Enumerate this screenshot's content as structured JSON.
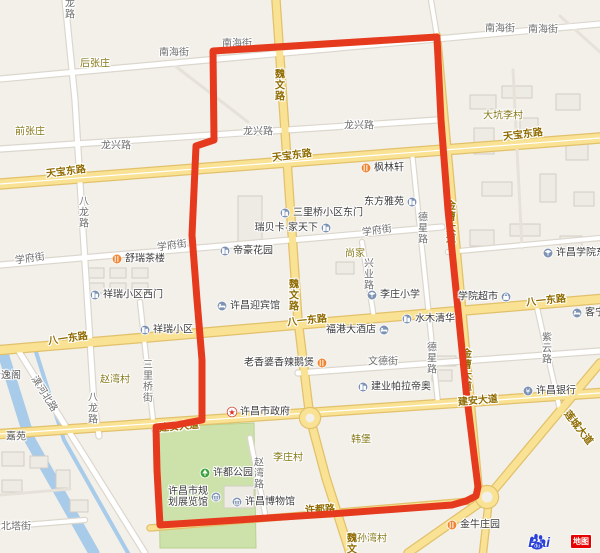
{
  "map": {
    "colors": {
      "background": "#f3f0ea",
      "route": "#e63a1e",
      "major_road": "#f9e293",
      "major_casing": "#e2c16b",
      "minor_road": "#ffffff",
      "minor_casing": "#dcd7cd",
      "faint_road": "#e7e2d9",
      "water": "#a7cbe9",
      "park": "#cde2ab",
      "building_fill": "#eeebe4",
      "building_stroke": "#d2cec5"
    },
    "water": [
      {
        "w": 11,
        "pts": [
          [
            2,
            350
          ],
          [
            30,
            440
          ],
          [
            94,
            553
          ]
        ]
      },
      {
        "w": 4,
        "pts": [
          [
            36,
            352
          ],
          [
            64,
            440
          ],
          [
            128,
            553
          ]
        ]
      }
    ],
    "park": {
      "name": "许都公园绿地",
      "points": [
        [
          158,
          427
        ],
        [
          254,
          423
        ],
        [
          256,
          548
        ],
        [
          160,
          548
        ]
      ]
    },
    "buildings": [
      [
        238,
        196,
        24,
        46
      ],
      [
        470,
        95,
        26,
        14
      ],
      [
        502,
        86,
        30,
        12
      ],
      [
        474,
        128,
        20,
        26
      ],
      [
        520,
        118,
        18,
        30
      ],
      [
        556,
        94,
        24,
        16
      ],
      [
        566,
        138,
        22,
        22
      ],
      [
        482,
        182,
        30,
        14
      ],
      [
        540,
        174,
        16,
        28
      ],
      [
        574,
        192,
        20,
        14
      ],
      [
        470,
        230,
        24,
        16
      ],
      [
        510,
        224,
        30,
        12
      ],
      [
        560,
        236,
        22,
        14
      ],
      [
        88,
        268,
        16,
        10
      ],
      [
        110,
        268,
        16,
        10
      ],
      [
        132,
        268,
        16,
        10
      ],
      [
        88,
        283,
        16,
        10
      ],
      [
        110,
        283,
        16,
        10
      ],
      [
        132,
        283,
        16,
        10
      ],
      [
        2,
        452,
        22,
        14
      ],
      [
        30,
        456,
        18,
        12
      ],
      [
        2,
        480,
        20,
        12
      ],
      [
        56,
        470,
        14,
        18
      ],
      [
        70,
        500,
        18,
        12
      ],
      [
        430,
        356,
        26,
        10
      ],
      [
        432,
        370,
        20,
        11
      ],
      [
        336,
        262,
        18,
        12
      ],
      [
        224,
        486,
        30,
        22
      ]
    ],
    "roads": [
      {
        "name": "小路1",
        "kind": "faint",
        "w": 3,
        "pts": [
          [
            170,
            62
          ],
          [
            248,
            122
          ]
        ]
      },
      {
        "name": "小路2",
        "kind": "faint",
        "w": 3,
        "pts": [
          [
            560,
            16
          ],
          [
            600,
            52
          ]
        ]
      },
      {
        "name": "校园路",
        "kind": "faint",
        "w": 3,
        "pts": [
          [
            513,
            70
          ],
          [
            522,
            248
          ]
        ]
      },
      {
        "name": "小路3",
        "kind": "faint",
        "w": 3,
        "pts": [
          [
            0,
            495
          ],
          [
            70,
            489
          ]
        ]
      },
      {
        "name": "南海街",
        "kind": "minor",
        "w": 5,
        "pts": [
          [
            0,
            79
          ],
          [
            600,
            24
          ]
        ]
      },
      {
        "name": "龙兴路",
        "kind": "minor",
        "w": 5,
        "pts": [
          [
            0,
            149
          ],
          [
            437,
            120
          ]
        ]
      },
      {
        "name": "学府街",
        "kind": "minor",
        "w": 5,
        "pts": [
          [
            0,
            265
          ],
          [
            442,
            227
          ]
        ]
      },
      {
        "name": "文德街",
        "kind": "minor",
        "w": 5,
        "pts": [
          [
            298,
            373
          ],
          [
            600,
            351
          ]
        ]
      },
      {
        "name": "八龙路",
        "kind": "minor",
        "w": 5,
        "pts": [
          [
            65,
            0
          ],
          [
            75,
            100
          ],
          [
            82,
            215
          ],
          [
            88,
            310
          ],
          [
            94,
            404
          ],
          [
            99,
            436
          ]
        ]
      },
      {
        "name": "三里桥街",
        "kind": "minor",
        "w": 4,
        "pts": [
          [
            140,
            302
          ],
          [
            154,
            429
          ]
        ]
      },
      {
        "name": "兴业路",
        "kind": "minor",
        "w": 4,
        "pts": [
          [
            362,
            242
          ],
          [
            374,
            318
          ]
        ]
      },
      {
        "name": "德星路",
        "kind": "minor",
        "w": 4,
        "pts": [
          [
            412,
            152
          ],
          [
            438,
            403
          ]
        ]
      },
      {
        "name": "紫云路",
        "kind": "minor",
        "w": 4,
        "pts": [
          [
            536,
            303
          ],
          [
            560,
            410
          ]
        ]
      },
      {
        "name": "赵湾路",
        "kind": "minor",
        "w": 4,
        "pts": [
          [
            250,
            438
          ],
          [
            265,
            513
          ]
        ]
      },
      {
        "name": "潩河北路",
        "kind": "minor",
        "w": 5,
        "pts": [
          [
            18,
            350
          ],
          [
            145,
            553
          ]
        ]
      },
      {
        "name": "北塔街",
        "kind": "minor",
        "w": 4,
        "pts": [
          [
            0,
            527
          ],
          [
            85,
            520
          ]
        ]
      },
      {
        "name": "小路4",
        "kind": "minor",
        "w": 4,
        "pts": [
          [
            431,
            0
          ],
          [
            437,
            36
          ]
        ]
      },
      {
        "name": "校园南路",
        "kind": "minor",
        "w": 4,
        "pts": [
          [
            448,
            252
          ],
          [
            600,
            238
          ]
        ]
      },
      {
        "name": "许都路",
        "kind": "major",
        "w": 5,
        "pts": [
          [
            150,
            528
          ],
          [
            470,
            501
          ]
        ]
      },
      {
        "name": "金曹大道",
        "kind": "major",
        "w": 6,
        "pts": [
          [
            437,
            36
          ],
          [
            479,
            492
          ]
        ]
      },
      {
        "name": "魏文路",
        "kind": "major",
        "w": 7,
        "pts": [
          [
            276,
            0
          ],
          [
            287,
            160
          ],
          [
            298,
            320
          ],
          [
            310,
            418
          ],
          [
            326,
            478
          ],
          [
            350,
            553
          ]
        ]
      },
      {
        "name": "天宝东路",
        "kind": "major",
        "w": 9,
        "center": 1,
        "pts": [
          [
            0,
            184
          ],
          [
            600,
            138
          ]
        ]
      },
      {
        "name": "八一东路",
        "kind": "major",
        "w": 8,
        "pts": [
          [
            0,
            350
          ],
          [
            600,
            299
          ]
        ]
      },
      {
        "name": "建安大道",
        "kind": "major",
        "w": 8,
        "center": 1,
        "pts": [
          [
            0,
            434
          ],
          [
            600,
            393
          ]
        ]
      },
      {
        "name": "莲城大道",
        "kind": "major",
        "w": 7,
        "pts": [
          [
            600,
            363
          ],
          [
            488,
            497
          ],
          [
            408,
            553
          ]
        ]
      },
      {
        "name": "莲城大道南支",
        "kind": "major",
        "w": 6,
        "pts": [
          [
            488,
            508
          ],
          [
            483,
            553
          ]
        ]
      }
    ],
    "roundabouts": [
      [
        310,
        418,
        10
      ],
      [
        487,
        497,
        11
      ]
    ],
    "route": {
      "width": 7,
      "points": [
        [
          213,
          51
        ],
        [
          437,
          37
        ],
        [
          441,
          120
        ],
        [
          448,
          210
        ],
        [
          457,
          300
        ],
        [
          466,
          390
        ],
        [
          474,
          455
        ],
        [
          478,
          487
        ],
        [
          476,
          496
        ],
        [
          466,
          501
        ],
        [
          452,
          505
        ],
        [
          330,
          514
        ],
        [
          160,
          525
        ],
        [
          157,
          470
        ],
        [
          156,
          427
        ],
        [
          176,
          425
        ],
        [
          202,
          420
        ],
        [
          202,
          360
        ],
        [
          197,
          300
        ],
        [
          192,
          235
        ],
        [
          196,
          146
        ],
        [
          214,
          140
        ],
        [
          213,
          51
        ]
      ]
    },
    "labels": [
      {
        "t": "南海街",
        "x": 174,
        "y": 53,
        "c": "minor"
      },
      {
        "t": "南海街",
        "x": 237,
        "y": 44,
        "c": "minor",
        "u": 1
      },
      {
        "t": "南海街",
        "x": 500,
        "y": 29,
        "c": "minor"
      },
      {
        "t": "南海街",
        "x": 543,
        "y": 30,
        "c": "minor"
      },
      {
        "t": "龙兴路",
        "x": 116,
        "y": 146,
        "c": "minor"
      },
      {
        "t": "龙兴路",
        "x": 258,
        "y": 132,
        "c": "minor"
      },
      {
        "t": "龙兴路",
        "x": 359,
        "y": 126,
        "c": "minor"
      },
      {
        "t": "学府街",
        "x": 30,
        "y": 259,
        "c": "minor",
        "r": -8
      },
      {
        "t": "学府街",
        "x": 172,
        "y": 246,
        "c": "minor",
        "r": -8
      },
      {
        "t": "学府街",
        "x": 377,
        "y": 231,
        "c": "minor",
        "r": -8
      },
      {
        "t": "文德街",
        "x": 383,
        "y": 362,
        "c": "minor"
      },
      {
        "t": "北塔街",
        "x": 16,
        "y": 527,
        "c": "minor"
      },
      {
        "t": "潩河北路",
        "x": 44,
        "y": 394,
        "c": "minor",
        "r": 58
      },
      {
        "t": "八龙路",
        "x": 68,
        "y": 3,
        "c": "minor",
        "v": 1
      },
      {
        "t": "八龙路",
        "x": 82,
        "y": 212,
        "c": "minor",
        "v": 1
      },
      {
        "t": "八龙路",
        "x": 91,
        "y": 408,
        "c": "minor",
        "v": 1
      },
      {
        "t": "三里桥街",
        "x": 146,
        "y": 381,
        "c": "minor",
        "v": 1
      },
      {
        "t": "兴业路",
        "x": 367,
        "y": 274,
        "c": "minor",
        "v": 1
      },
      {
        "t": "德星路",
        "x": 421,
        "y": 228,
        "c": "minor",
        "v": 1
      },
      {
        "t": "德星路",
        "x": 430,
        "y": 358,
        "c": "minor",
        "v": 1
      },
      {
        "t": "紫云路",
        "x": 545,
        "y": 348,
        "c": "minor",
        "v": 1
      },
      {
        "t": "赵湾路",
        "x": 257,
        "y": 473,
        "c": "minor",
        "v": 1
      },
      {
        "t": "魏文路",
        "x": 278,
        "y": 85,
        "c": "major",
        "v": 1
      },
      {
        "t": "魏文路",
        "x": 292,
        "y": 295,
        "c": "major",
        "v": 1
      },
      {
        "t": "魏文路",
        "x": 350,
        "y": 549,
        "c": "major",
        "v": 1
      },
      {
        "t": "天宝东路",
        "x": 66,
        "y": 172,
        "c": "major",
        "r": -7
      },
      {
        "t": "天宝东路",
        "x": 292,
        "y": 156,
        "c": "major",
        "r": -7
      },
      {
        "t": "天宝东路",
        "x": 523,
        "y": 135,
        "c": "major",
        "r": -7
      },
      {
        "t": "八一东路",
        "x": 68,
        "y": 339,
        "c": "major",
        "r": -8
      },
      {
        "t": "八一东路",
        "x": 307,
        "y": 321,
        "c": "major",
        "r": -6
      },
      {
        "t": "八一东路",
        "x": 546,
        "y": 301,
        "c": "major",
        "r": -6
      },
      {
        "t": "建安大道",
        "x": 478,
        "y": 401,
        "c": "major",
        "r": -5
      },
      {
        "t": "建安大道",
        "x": 179,
        "y": 427,
        "c": "major",
        "r": -5,
        "u": 1
      },
      {
        "t": "莲城大道",
        "x": 578,
        "y": 428,
        "c": "major",
        "r": 52
      },
      {
        "t": "金曹大道",
        "x": 449,
        "y": 222,
        "c": "major",
        "v": 1,
        "u": 1
      },
      {
        "t": "金曹大道",
        "x": 465,
        "y": 370,
        "c": "major",
        "v": 1,
        "u": 1
      },
      {
        "t": "许都路",
        "x": 320,
        "y": 510,
        "c": "major",
        "r": -3,
        "u": 1
      },
      {
        "t": "后张庄",
        "x": 95,
        "y": 64,
        "c": "village"
      },
      {
        "t": "前张庄",
        "x": 30,
        "y": 132,
        "c": "village"
      },
      {
        "t": "大坑李村",
        "x": 503,
        "y": 116,
        "c": "village"
      },
      {
        "t": "尚家",
        "x": 355,
        "y": 254,
        "c": "village"
      },
      {
        "t": "赵湾村",
        "x": 115,
        "y": 380,
        "c": "village"
      },
      {
        "t": "李庄村",
        "x": 288,
        "y": 458,
        "c": "village"
      },
      {
        "t": "韩堡",
        "x": 361,
        "y": 440,
        "c": "village"
      },
      {
        "t": "孙湾村",
        "x": 372,
        "y": 539,
        "c": "village"
      },
      {
        "t": "嘉苑",
        "x": 16,
        "y": 437,
        "c": "dark"
      },
      {
        "t": "清逸阁",
        "x": 6,
        "y": 376,
        "c": "dark"
      }
    ],
    "pois": [
      {
        "n": "枫林轩",
        "icon": "food",
        "x": 366,
        "y": 168,
        "side": "right"
      },
      {
        "n": "三里桥小区东门",
        "icon": "building",
        "x": 285,
        "y": 213,
        "side": "right"
      },
      {
        "n": "瑞贝卡·家天下",
        "icon": "building",
        "x": 326,
        "y": 228,
        "side": "left"
      },
      {
        "n": "帝豪花园",
        "icon": "building",
        "x": 225,
        "y": 251,
        "side": "right"
      },
      {
        "n": "舒瑞茶楼",
        "icon": "food",
        "x": 117,
        "y": 259,
        "side": "right"
      },
      {
        "n": "祥瑞小区西门",
        "icon": "building",
        "x": 95,
        "y": 295,
        "side": "right"
      },
      {
        "n": "许昌迎宾馆",
        "icon": "hotel",
        "x": 222,
        "y": 306,
        "side": "right"
      },
      {
        "n": "福港大酒店",
        "icon": "hotel",
        "x": 384,
        "y": 330,
        "side": "left"
      },
      {
        "n": "祥瑞小区",
        "icon": "building",
        "x": 145,
        "y": 330,
        "side": "right"
      },
      {
        "n": "老香婆香辣鹅煲",
        "icon": "food",
        "x": 322,
        "y": 363,
        "side": "left"
      },
      {
        "n": "水木清华",
        "icon": "building",
        "x": 407,
        "y": 319,
        "side": "right"
      },
      {
        "n": "东方雅苑",
        "icon": "building",
        "x": 412,
        "y": 202,
        "side": "left"
      },
      {
        "n": "建业帕拉帝奥",
        "icon": "building",
        "x": 363,
        "y": 387,
        "side": "right"
      },
      {
        "n": "许昌银行",
        "icon": "bank",
        "x": 528,
        "y": 391,
        "side": "right"
      },
      {
        "n": "许昌市政府",
        "icon": "gov",
        "x": 232,
        "y": 412,
        "side": "right"
      },
      {
        "n": "许都公园",
        "icon": "park",
        "x": 205,
        "y": 473,
        "side": "right"
      },
      {
        "n": "许昌博物馆",
        "icon": "museum",
        "x": 237,
        "y": 502,
        "side": "right"
      },
      {
        "n": "许昌市规划展览馆",
        "icon": "museum",
        "x": 216,
        "y": 497,
        "side": "left",
        "lines": [
          "许昌市规",
          "划展览馆"
        ]
      },
      {
        "n": "李庄小学",
        "icon": "school",
        "x": 372,
        "y": 295,
        "side": "right"
      },
      {
        "n": "许昌学院东校区",
        "icon": "school",
        "x": 548,
        "y": 253,
        "side": "right"
      },
      {
        "n": "学院超市",
        "icon": "shop",
        "x": 506,
        "y": 297,
        "side": "left"
      },
      {
        "n": "客宁",
        "icon": "hotel",
        "x": 577,
        "y": 313,
        "side": "right"
      },
      {
        "n": "金牛庄园",
        "icon": "food",
        "x": 452,
        "y": 525,
        "side": "right"
      }
    ]
  },
  "logo": {
    "bai": "Bai",
    "du": "du",
    "badge": "地图"
  }
}
